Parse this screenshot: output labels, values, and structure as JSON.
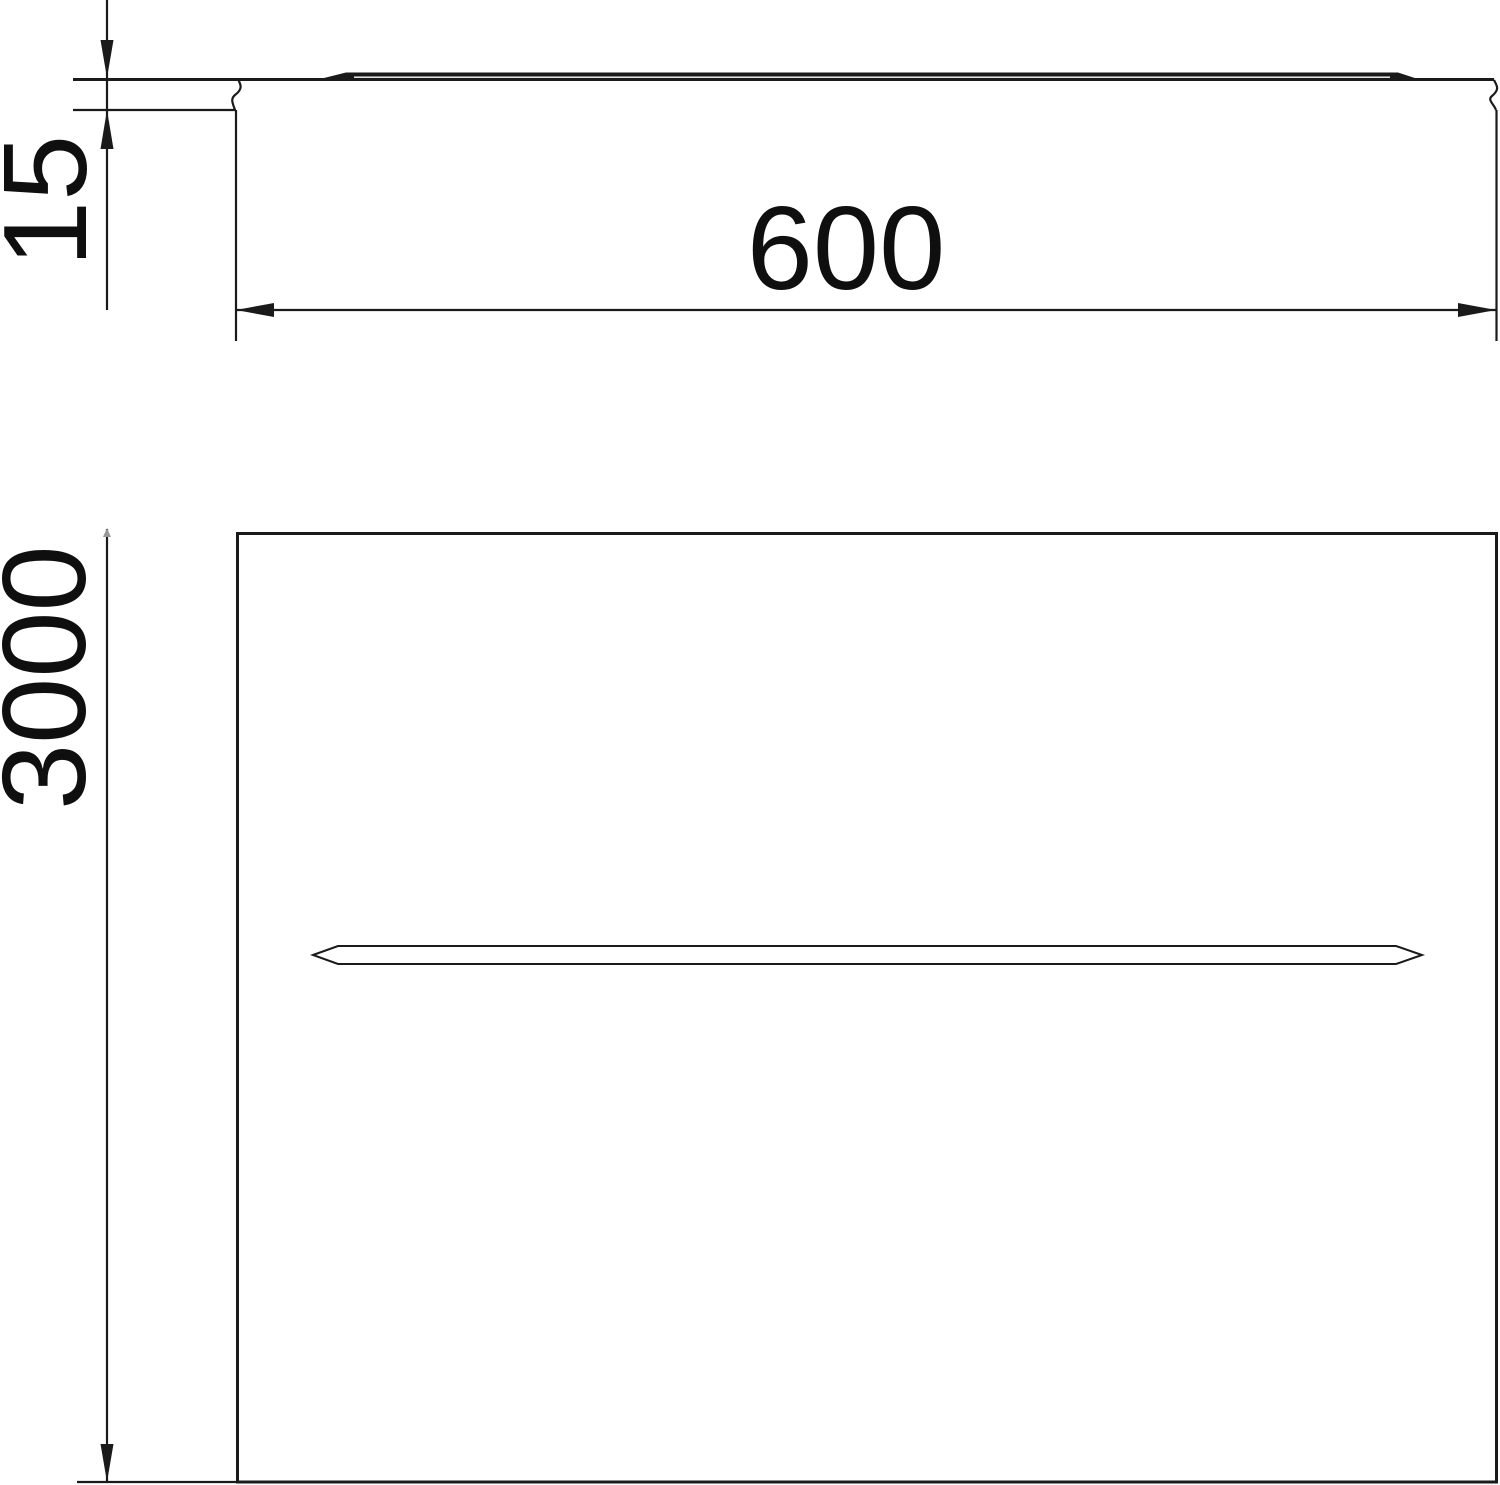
{
  "page": {
    "background": "#ffffff"
  },
  "drawing": {
    "line_color": "#1a1a1a",
    "section_view": {
      "height_label": "15",
      "width_label": "600"
    },
    "plan_view": {
      "length_label": "3000"
    }
  }
}
